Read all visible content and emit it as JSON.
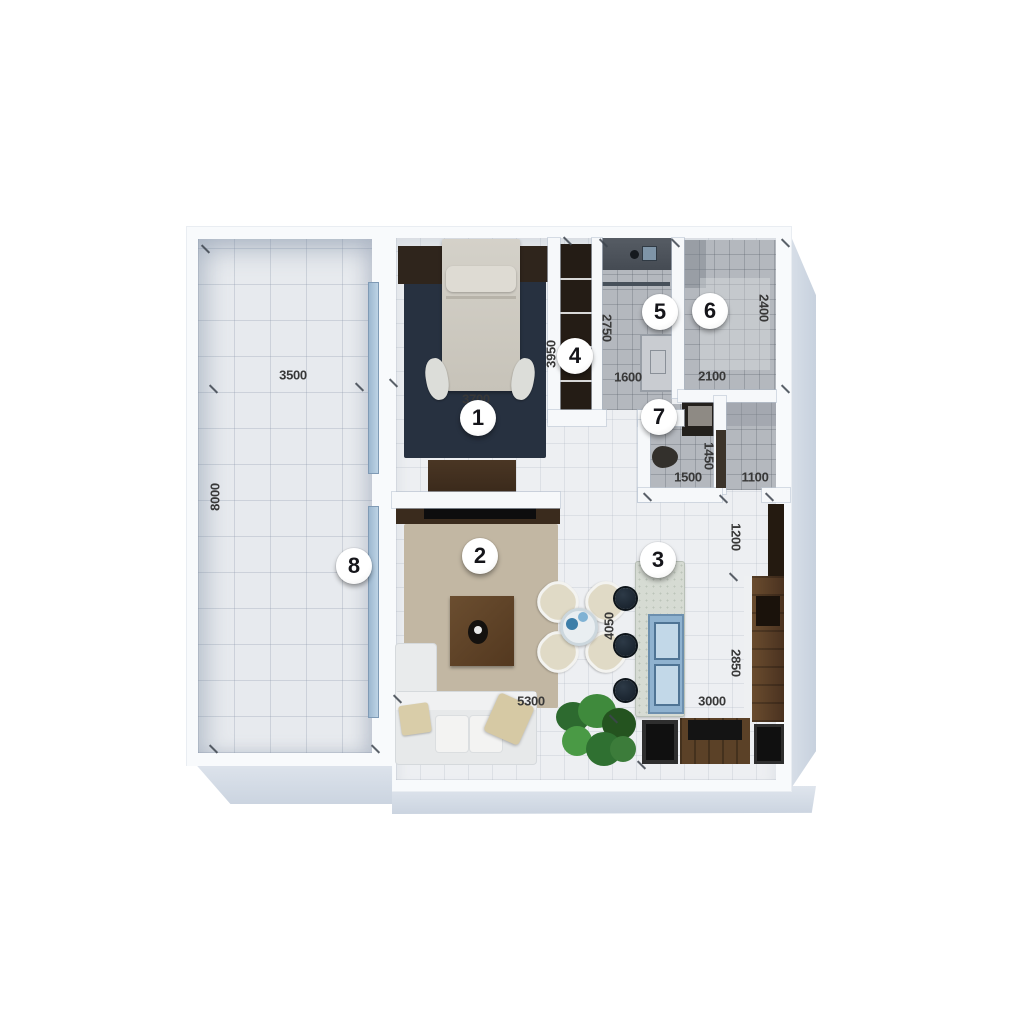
{
  "plan": {
    "badges": [
      {
        "label": "1"
      },
      {
        "label": "2"
      },
      {
        "label": "3"
      },
      {
        "label": "4"
      },
      {
        "label": "5"
      },
      {
        "label": "6"
      },
      {
        "label": "7"
      },
      {
        "label": "8"
      }
    ],
    "dimensions": [
      {
        "text": "3500"
      },
      {
        "text": "8000"
      },
      {
        "text": "3700"
      },
      {
        "text": "3950"
      },
      {
        "text": "2750"
      },
      {
        "text": "1600"
      },
      {
        "text": "2100"
      },
      {
        "text": "2400"
      },
      {
        "text": "1500"
      },
      {
        "text": "1450"
      },
      {
        "text": "1100"
      },
      {
        "text": "1200"
      },
      {
        "text": "4050"
      },
      {
        "text": "5300"
      },
      {
        "text": "2850"
      },
      {
        "text": "3000"
      }
    ],
    "colors": {
      "background": "#ffffff",
      "wall": "#f8fafc",
      "shadow_band": "#cdd6e1",
      "balcony_tile": "#e7eaee",
      "interior_tile": "#edeff2",
      "gray_tile": "#b4b8be",
      "rug_navy": "#273140",
      "rug_beige": "#c2b7a3",
      "wood_dark": "#3c2b1c",
      "wood_mid": "#5f4529",
      "glass_blue": "#a9c2d8",
      "appliance_blue": "#8fb2cf",
      "stool_dark": "#1d2731",
      "plant_green": "#3c7c3a",
      "dim_text": "#383838",
      "badge_bg": "#ffffff"
    }
  }
}
